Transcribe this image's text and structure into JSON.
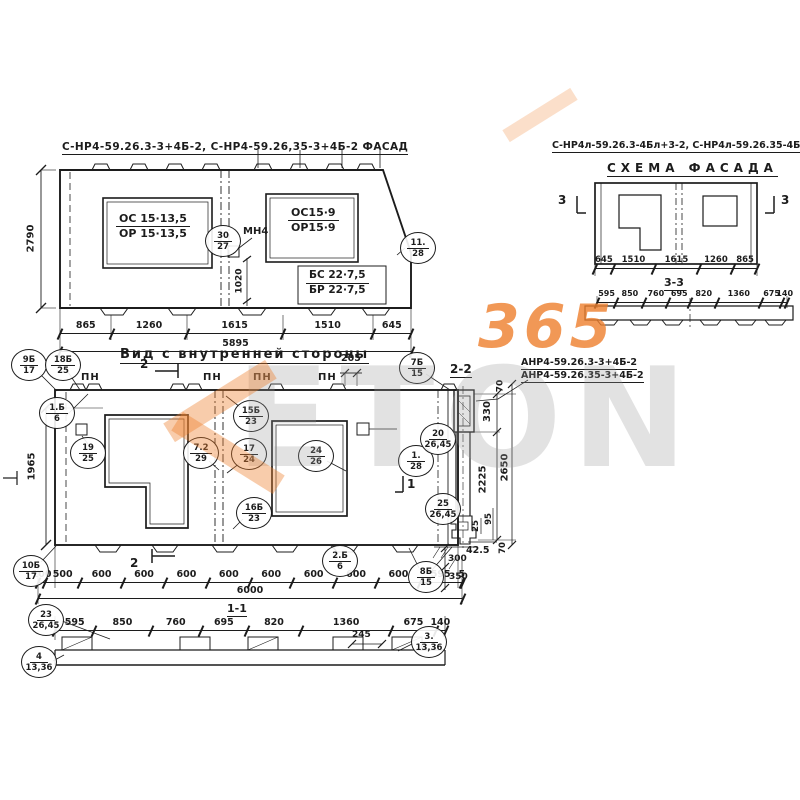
{
  "watermark": {
    "number": "365",
    "word": "ETON"
  },
  "facade": {
    "title": "С-НР4-59.26.3-3+4Б-2, С-НР4-59.26,35-3+4Б-2  ФАСАД",
    "opening_left": {
      "num": "ОС 15·13,5",
      "den": "ОР 15·13,5"
    },
    "opening_right": {
      "num": "ОС15·9",
      "den": "ОР15·9"
    },
    "balcony": {
      "num": "БС 22·7,5",
      "den": "БР 22·7,5"
    },
    "mount_label": "МН4",
    "callout_anchor": {
      "top": "30",
      "bottom": "27"
    },
    "callout_corner": {
      "top": "11.",
      "bottom": "28"
    },
    "dim_height": "2790",
    "dim_anchor": "1020",
    "dims": [
      "865",
      "1260",
      "1615",
      "1510",
      "645"
    ],
    "total": "5895"
  },
  "inner": {
    "title": "Вид с внутренней стороны",
    "pn": "ПН",
    "sec2": "2",
    "sec1": "1",
    "dim_top": "205",
    "dim_left": "1965",
    "dims": [
      "100",
      "500",
      "600",
      "600",
      "600",
      "600",
      "600",
      "600",
      "600",
      "600",
      "595",
      "5"
    ],
    "total": "6000",
    "callouts": [
      {
        "top": "9Б",
        "bottom": "17"
      },
      {
        "top": "18Б",
        "bottom": "25"
      },
      {
        "top": "1.Б",
        "bottom": "6"
      },
      {
        "top": "19",
        "bottom": "25"
      },
      {
        "top": "15Б",
        "bottom": "23"
      },
      {
        "top": "7.2",
        "bottom": "29"
      },
      {
        "top": "17",
        "bottom": "24"
      },
      {
        "top": "24",
        "bottom": "26"
      },
      {
        "top": "16Б",
        "bottom": "23"
      },
      {
        "top": "7Б",
        "bottom": "15"
      },
      {
        "top": "1.",
        "bottom": "28"
      },
      {
        "top": "10Б",
        "bottom": "17"
      },
      {
        "top": "2.Б",
        "bottom": "6"
      },
      {
        "top": "8Б",
        "bottom": "15"
      }
    ]
  },
  "section11": {
    "label": "1-1",
    "dims": [
      "595",
      "850",
      "760",
      "695",
      "820",
      "1360",
      "675",
      "140"
    ],
    "dim_245": "245",
    "callouts": [
      {
        "top": "23",
        "bottom": "26,45"
      },
      {
        "top": "4",
        "bottom": "13,36"
      },
      {
        "top": "3.",
        "bottom": "13,36"
      }
    ]
  },
  "section22": {
    "label": "2-2",
    "codes": [
      "АНР4-59.26.3-3+4Б-2",
      "АНР4-59.26.35-3+4Б-2"
    ],
    "dim_70_top": "70",
    "dim_330": "330",
    "dim_2225": "2225",
    "dim_2650": "2650",
    "dim_25": "25",
    "dim_95": "95",
    "dim_425": "42.5",
    "dim_70_bottom": "70",
    "dim_300": "300",
    "dim_350": "350",
    "callouts": [
      {
        "top": "20",
        "bottom": "26,45"
      },
      {
        "top": "25",
        "bottom": "26,45"
      }
    ]
  },
  "schema": {
    "title": "С-НР4л-59.26.3-4Бл+3-2, С-НР4л-59.26.35-4Бл+3-2",
    "subtitle": "СХЕМА ФАСАДА",
    "sec3": "3",
    "dims": [
      "645",
      "1510",
      "1615",
      "1260",
      "865"
    ],
    "section_label": "3-3",
    "section_dims": [
      "595",
      "850",
      "760",
      "695",
      "820",
      "1360",
      "675",
      "140"
    ]
  }
}
